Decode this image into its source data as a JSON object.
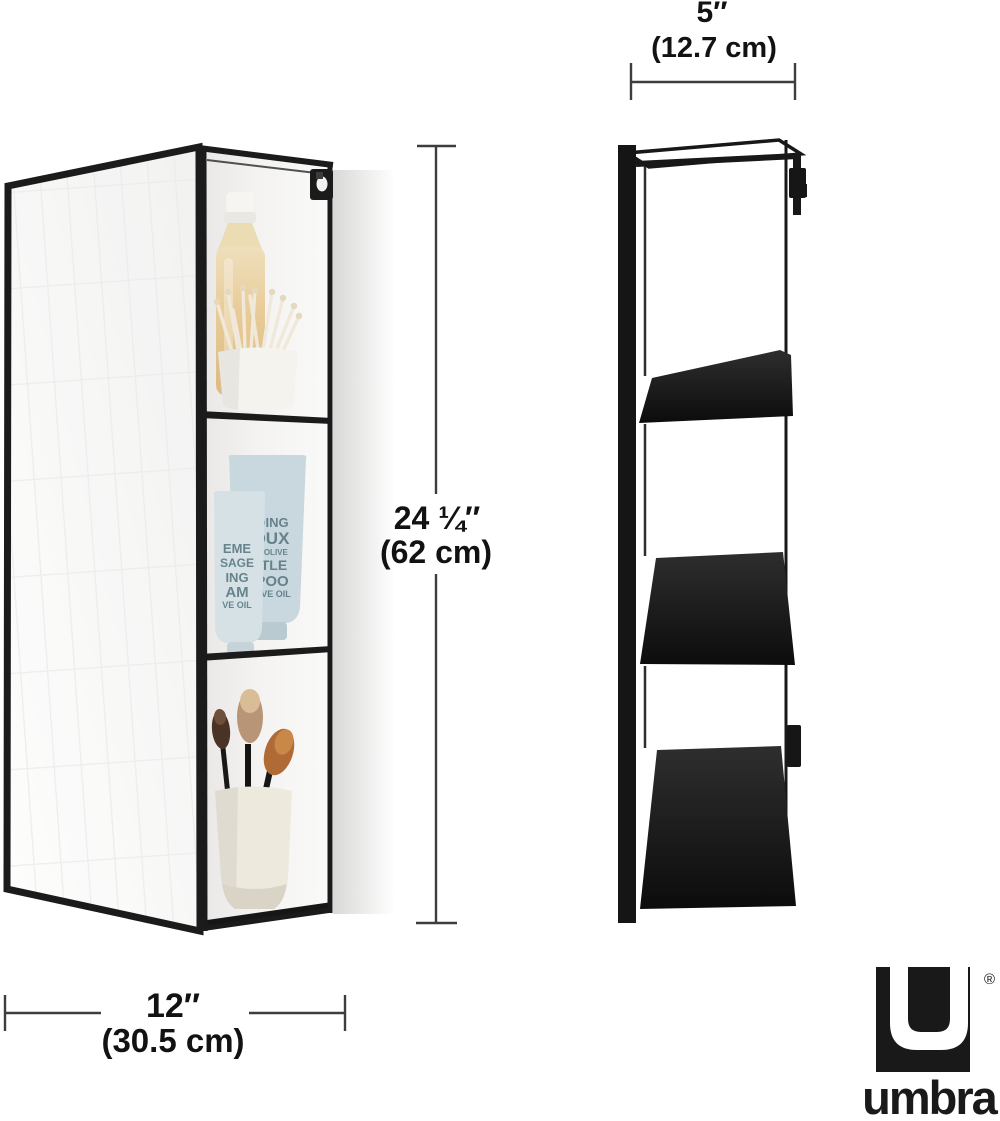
{
  "dimensions": {
    "top_width": {
      "inches": "5″",
      "metric": "(12.7 cm)"
    },
    "height": {
      "inches": "24 ¼″",
      "metric": "(62 cm)"
    },
    "bottom_width": {
      "inches": "12″",
      "metric": "(30.5 cm)"
    }
  },
  "brand": {
    "logo_text": "umbra",
    "registered_mark": "®"
  },
  "products": {
    "front_view_items": [
      "shampoo-bottle",
      "cotton-swab-cup",
      "cosmetic-tubes",
      "makeup-brush-cup"
    ],
    "tubes": {
      "large_lines": [
        "OING",
        "OUX",
        "D'OLIVE",
        "ITLE",
        "POO",
        "LIVE OIL"
      ],
      "small_lines": [
        "EME",
        "SAGE",
        "ING",
        "AM",
        "VE OIL"
      ]
    }
  },
  "colors": {
    "frame_black": "#1b1b1b",
    "dimension_line": "#3d3d3d",
    "label_text": "#121212",
    "tube_blue": "#c9d8de",
    "tube_blue_light": "#d6e1e6",
    "tube_text_teal": "#54747e",
    "bottle_tan": "#e6c893",
    "cup_cream": "#eee9dd",
    "mirror_tint": "#f4f4f3"
  }
}
